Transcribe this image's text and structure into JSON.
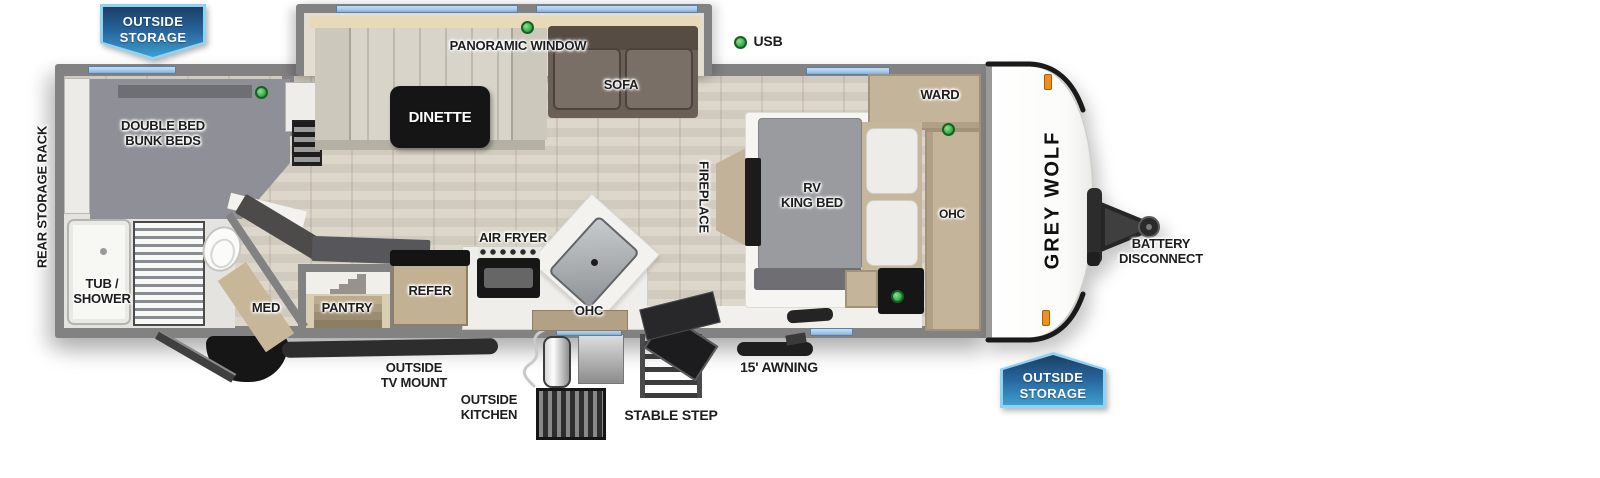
{
  "title": "Grey Wolf travel trailer floor plan",
  "colors": {
    "wall": "#828282",
    "floor": "#d8d1c5",
    "window-blue": "#a9cbe8",
    "led-green": "#3fae4c",
    "tan": "#c4b49a",
    "marker-orange": "#ef8f1d",
    "banner-light": "#8ed4f2",
    "banner-dark": "#1b3f66",
    "banner-mid": "#27659c",
    "banner-bright": "#3e9ecf"
  },
  "banners": {
    "top_left": {
      "line1": "OUTSIDE",
      "line2": "STORAGE"
    },
    "bottom_right": {
      "line1": "OUTSIDE",
      "line2": "STORAGE"
    }
  },
  "exterior": {
    "rear_storage_rack": "REAR STORAGE RACK",
    "usb": "USB",
    "outside_tv_mount": {
      "line1": "OUTSIDE",
      "line2": "TV MOUNT"
    },
    "outside_kitchen": {
      "line1": "OUTSIDE",
      "line2": "KITCHEN"
    },
    "stable_step": "STABLE STEP",
    "awning": "15' AWNING",
    "battery_disconnect": {
      "line1": "BATTERY",
      "line2": "DISCONNECT"
    },
    "brand": "GREY WOLF"
  },
  "rooms": {
    "bunk": {
      "line1": "DOUBLE BED",
      "line2": "BUNK BEDS"
    },
    "bath": {
      "line1": "TUB /",
      "line2": "SHOWER"
    },
    "med": "MED",
    "pantry": "PANTRY",
    "refer": "REFER",
    "air_fryer": "AIR FRYER",
    "ohc_kitchen": "OHC",
    "panoramic_window": "PANORAMIC WINDOW",
    "dinette": "DINETTE",
    "sofa": "SOFA",
    "fireplace": "FIREPLACE",
    "king_bed": {
      "line1": "RV",
      "line2": "KING BED"
    },
    "ward": "WARD",
    "ohc_bedroom": "OHC"
  }
}
